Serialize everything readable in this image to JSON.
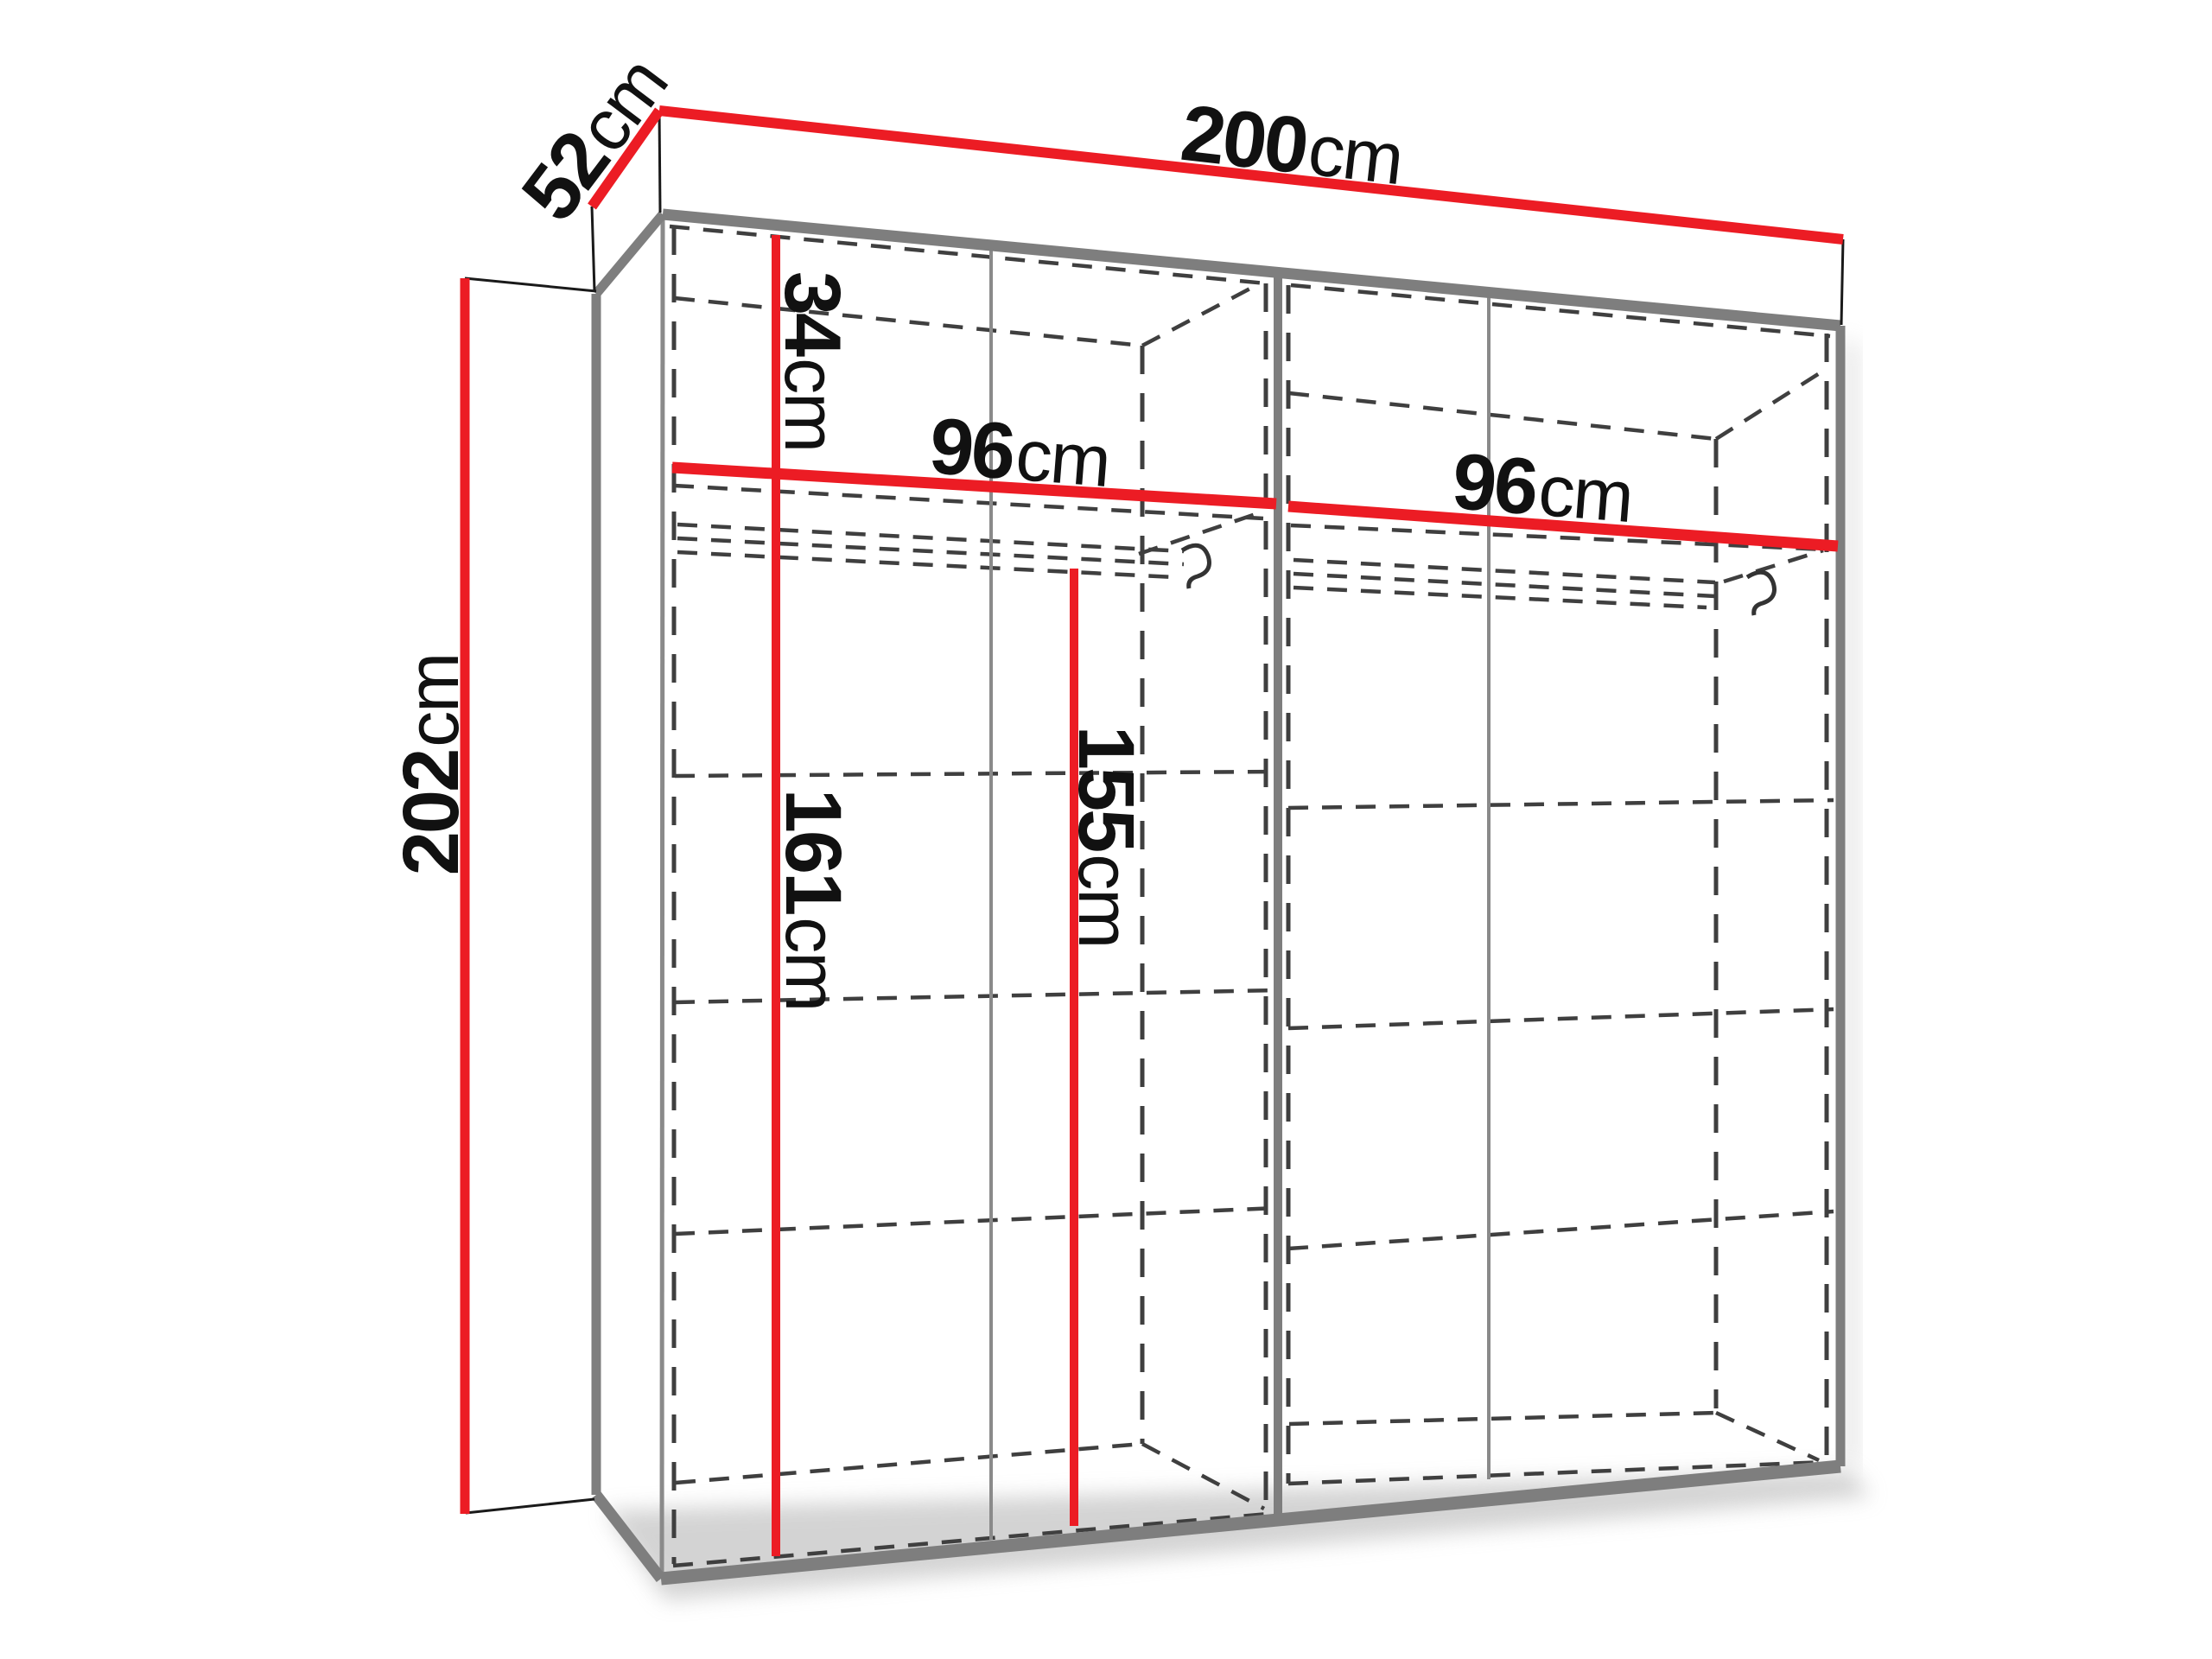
{
  "diagram": {
    "name": "wardrobe-dimension-diagram",
    "unit": "cm",
    "accent_color": "#ec1c24",
    "edge_color": "#7e7e7e",
    "hidden_line_color": "#3f3f3f",
    "dimensions": {
      "width": {
        "value": "200",
        "unit": "cm"
      },
      "depth": {
        "value": "52",
        "unit": "cm"
      },
      "height": {
        "value": "202",
        "unit": "cm"
      },
      "top_compartment": {
        "value": "34",
        "unit": "cm"
      },
      "left_section_width": {
        "value": "96",
        "unit": "cm"
      },
      "right_section_width": {
        "value": "96",
        "unit": "cm"
      },
      "left_interior_height": {
        "value": "161",
        "unit": "cm"
      },
      "rail_height": {
        "value": "155",
        "unit": "cm"
      }
    }
  }
}
